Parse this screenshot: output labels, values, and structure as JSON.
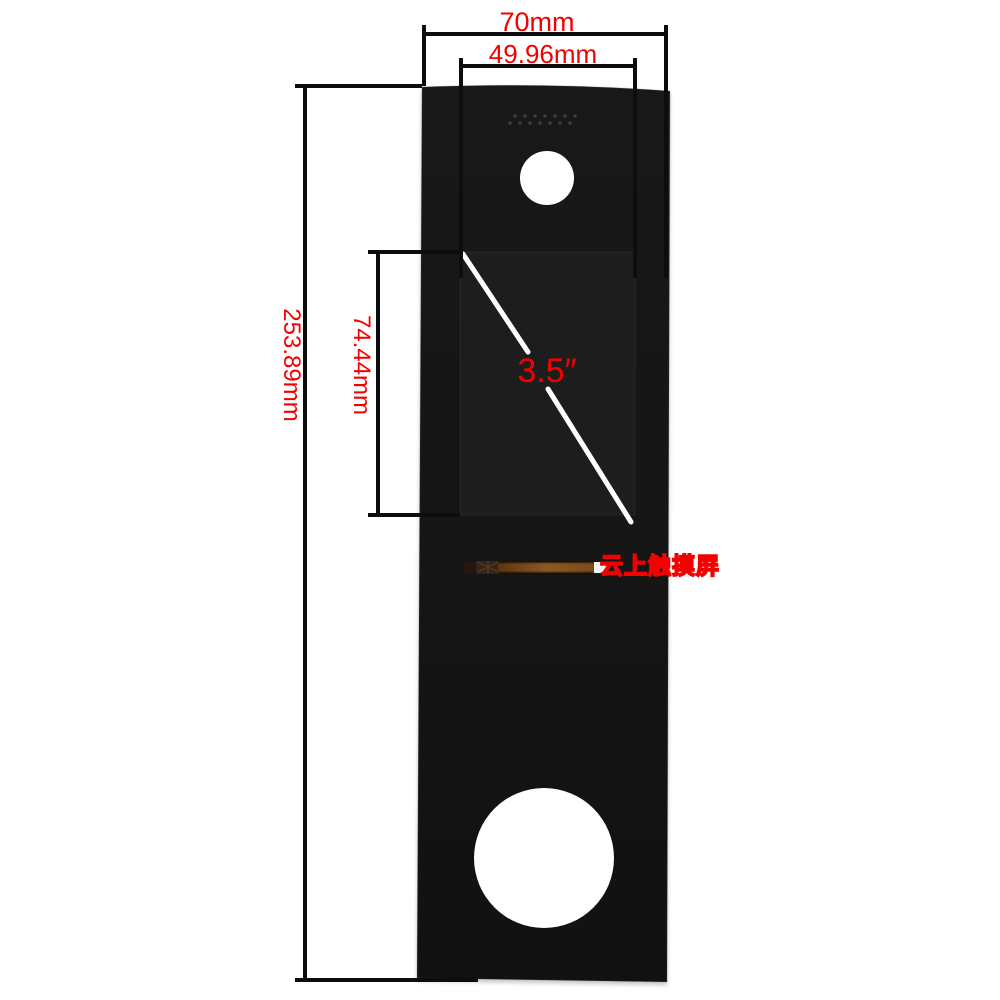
{
  "labels": {
    "outer_width": "70mm",
    "inner_width": "49.96mm",
    "outer_height": "253.89mm",
    "screen_height": "74.44mm",
    "screen_diagonal": "3.5″",
    "watermark": "云上触摸屏"
  },
  "colors": {
    "background": "#ffffff",
    "annotation_red": "#f40000",
    "dimension_line": "#0d0d0d",
    "panel_black": "#161616",
    "screen_black": "#1d1d1d",
    "hole_white": "#ffffff",
    "cable_brown": "#7a4a1c",
    "cable_end_white": "#f5f5f5",
    "diagonal_white": "#ffffff",
    "speaker_dot": "#4a4139"
  }
}
